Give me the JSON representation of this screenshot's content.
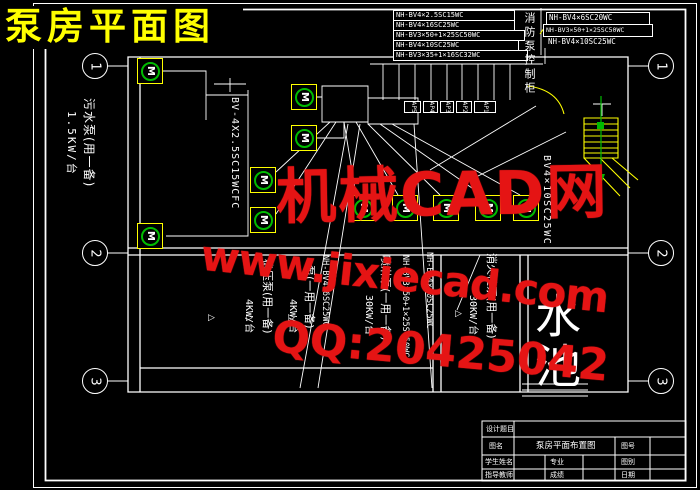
{
  "page_title": "泵房平面图",
  "watermark": {
    "brand": "机械CAD网",
    "url": "www.jixiecad.com",
    "qq": "QQ:20425042",
    "color": "#e51414"
  },
  "colors": {
    "line": "#ffffff",
    "highlight": "#ffff00",
    "motor": "#00bb00",
    "title": "#ffff00"
  },
  "axes": {
    "left": [
      "1",
      "2",
      "3"
    ],
    "right": [
      "1",
      "2",
      "3"
    ]
  },
  "cables_left": [
    "NH-BV4×2.5SC15WC",
    "NH-BV4×16SC25WC",
    "NH-BV3×50+1×25SC50WC",
    "NH-BV4×10SC25WC",
    "NH-BV3×35+1×16SC32WC"
  ],
  "cables_right": [
    "NH-BV4×6SC20WC",
    "NH-BV3×50+1×25SC50WC",
    "NH-BV4×10SC25WC"
  ],
  "panel_tags": [
    "AP5",
    "AP4",
    "AP3",
    "AP2",
    "AP1"
  ],
  "control_cabinet": "消防泵控制柜",
  "pool_label": "水池",
  "motor_letter": "M",
  "pump_mark": "▷",
  "vlabels": {
    "sewage_pump": "污水泵(用一备)",
    "sewage_power": "1.5KW/台",
    "feeder_left": "BV-4X2.5SC15WCFC",
    "feeder_right": "BV4×10SC25WC",
    "stabilize_power": "4KW/台",
    "stabilize_pump": "稳压泵(用一备)",
    "life_power": "4KW/台",
    "life_pump": "泵(一用一备)",
    "cable_a": "NH-BV4×6SC25WC",
    "spray_power": "30KW/台",
    "spray_pump": "喷淋泵(一用一备)",
    "cable_b": "NH-BV3×50+1×25SC50WC",
    "cable_c": "NH-BV4×10SC25WC",
    "hydrant_power": "30KW/台",
    "hydrant_pump": "消火栓泵(用一备)"
  },
  "title_block": {
    "project_label": "设计题目",
    "name_label": "图名",
    "drawing_name": "泵房平面布置图",
    "number_label": "图号",
    "student_label": "学生姓名",
    "major_label": "专业",
    "category_label": "图别",
    "advisor_label": "指导教师",
    "grade_label": "成绩",
    "date_label": "日期"
  }
}
